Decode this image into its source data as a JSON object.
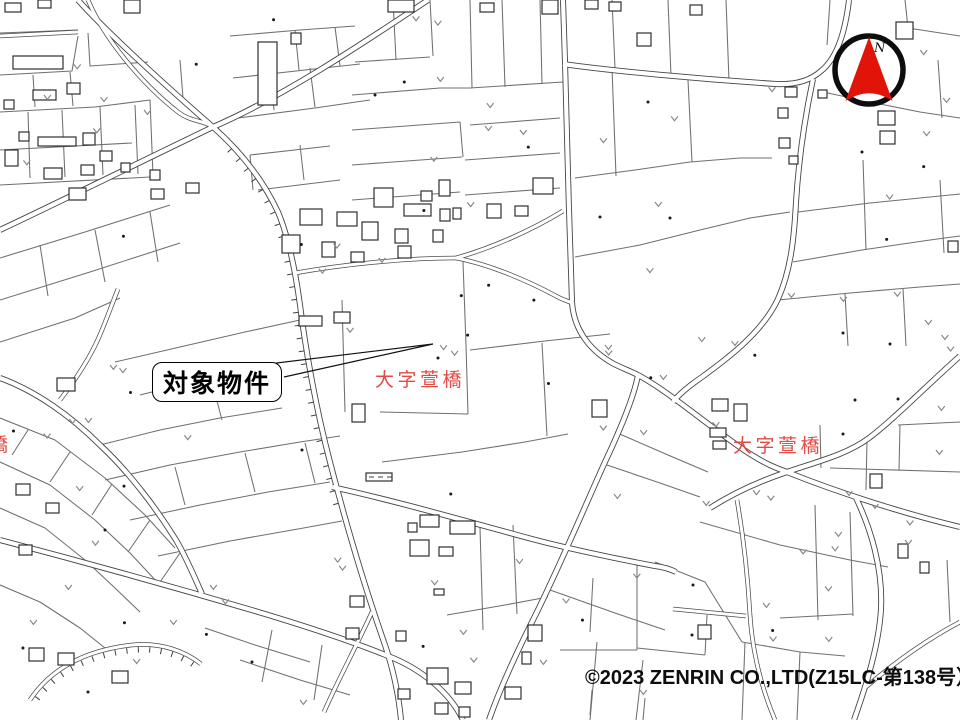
{
  "map": {
    "callout": {
      "label": "対象物件"
    },
    "place_labels": {
      "center": "大字萱橋",
      "east": "大字萱橋",
      "west_partial": "橋"
    },
    "compass": {
      "label": "N"
    },
    "copyright": "©2023 ZENRIN CO.,LTD(Z15LC-第138号）",
    "colors": {
      "place_label": "#e23b35",
      "compass_arrow": "#e1140a",
      "road_casing": "#464646",
      "parcel_line": "#6f6f6f",
      "building_outline": "#2e2e2e"
    }
  }
}
